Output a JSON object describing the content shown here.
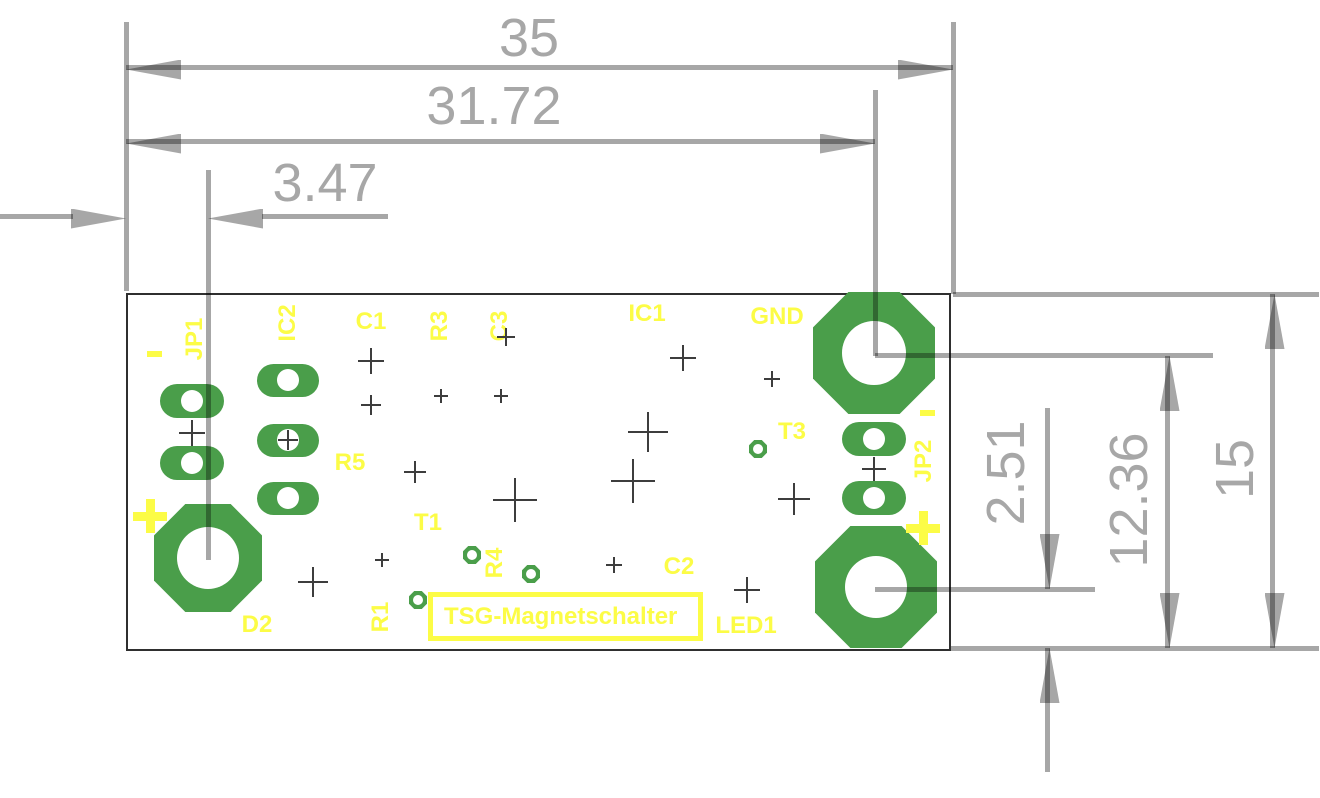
{
  "colors": {
    "pad_green": "#4a9e4a",
    "silk_yellow": "#fcfc46",
    "dim_gray": "#a7a7a7",
    "cross_dark": "#3d3d3d",
    "board_outline": "#2f2f2f"
  },
  "board": {
    "title": "TSG-Magnetschalter",
    "outline": {
      "x": 126,
      "y": 293,
      "w": 825,
      "h": 358
    },
    "title_box": {
      "x": 428,
      "y": 592,
      "w": 275,
      "h": 49
    }
  },
  "dimensions": {
    "texts": [
      {
        "name": "dim-text-35",
        "text": "35",
        "x": 529,
        "y": 38,
        "rot": 0
      },
      {
        "name": "dim-text-31-72",
        "text": "31.72",
        "x": 494,
        "y": 106,
        "rot": 0
      },
      {
        "name": "dim-text-3-47",
        "text": "3.47",
        "x": 325,
        "y": 183,
        "rot": 0
      },
      {
        "name": "dim-text-2-51",
        "text": "2.51",
        "x": 1006,
        "y": 473,
        "rot": -90
      },
      {
        "name": "dim-text-12-36",
        "text": "12.36",
        "x": 1129,
        "y": 500,
        "rot": -90
      },
      {
        "name": "dim-text-15",
        "text": "15",
        "x": 1235,
        "y": 469,
        "rot": -90
      }
    ],
    "lines": [
      {
        "name": "dim-line-35",
        "x": 126,
        "y": 65,
        "w": 827,
        "h": 5
      },
      {
        "name": "dim-line-31-72",
        "x": 126,
        "y": 139,
        "w": 749,
        "h": 5
      },
      {
        "name": "dim-tail-3-47-left",
        "x": 0,
        "y": 214,
        "w": 73,
        "h": 5
      },
      {
        "name": "dim-tail-3-47-right",
        "x": 262,
        "y": 214,
        "w": 126,
        "h": 5
      },
      {
        "name": "ext-line-left-edge",
        "x": 124,
        "y": 22,
        "w": 5,
        "h": 269
      },
      {
        "name": "ext-line-d2-center",
        "x": 206,
        "y": 170,
        "w": 5,
        "h": 390
      },
      {
        "name": "ext-line-gnd-center",
        "x": 873,
        "y": 90,
        "w": 5,
        "h": 266
      },
      {
        "name": "ext-line-right-edge",
        "x": 951,
        "y": 22,
        "w": 5,
        "h": 272
      },
      {
        "name": "ext-line-board-top",
        "x": 953,
        "y": 292,
        "w": 366,
        "h": 5
      },
      {
        "name": "ext-line-gnd-right",
        "x": 875,
        "y": 353,
        "w": 338,
        "h": 5
      },
      {
        "name": "ext-line-plus-right",
        "x": 875,
        "y": 587,
        "w": 220,
        "h": 5
      },
      {
        "name": "ext-line-board-bottom",
        "x": 951,
        "y": 646,
        "w": 368,
        "h": 5
      },
      {
        "name": "dim-line-15",
        "x": 1270,
        "y": 294,
        "w": 5,
        "h": 354
      },
      {
        "name": "dim-line-12-36",
        "x": 1165,
        "y": 356,
        "w": 5,
        "h": 292
      },
      {
        "name": "dim-line-2-51-upper",
        "x": 1045,
        "y": 408,
        "w": 5,
        "h": 181
      },
      {
        "name": "dim-line-2-51-lower",
        "x": 1045,
        "y": 648,
        "w": 5,
        "h": 124
      }
    ],
    "arrows": [
      {
        "dir": "left",
        "x": 126,
        "y": 67
      },
      {
        "dir": "right",
        "x": 953,
        "y": 67
      },
      {
        "dir": "left",
        "x": 126,
        "y": 141
      },
      {
        "dir": "right",
        "x": 875,
        "y": 141
      },
      {
        "dir": "right",
        "x": 126,
        "y": 216
      },
      {
        "dir": "left",
        "x": 208,
        "y": 216
      },
      {
        "dir": "up",
        "x": 1272,
        "y": 294
      },
      {
        "dir": "down",
        "x": 1272,
        "y": 648
      },
      {
        "dir": "up",
        "x": 1167,
        "y": 356
      },
      {
        "dir": "down",
        "x": 1167,
        "y": 648
      },
      {
        "dir": "down",
        "x": 1047,
        "y": 589
      },
      {
        "dir": "up",
        "x": 1047,
        "y": 648
      }
    ]
  },
  "pads": {
    "octagons": [
      {
        "name": "pad-d2",
        "cx": 208,
        "cy": 558,
        "size": 108,
        "hole_r": 31
      },
      {
        "name": "pad-gnd",
        "cx": 874,
        "cy": 353,
        "size": 122,
        "hole_r": 32
      },
      {
        "name": "pad-led-plus",
        "cx": 876,
        "cy": 587,
        "size": 122,
        "hole_r": 31
      }
    ],
    "ovals": [
      {
        "name": "pad-jp1-1",
        "cx": 192,
        "cy": 401,
        "w": 64,
        "h": 34,
        "hole_r": 11
      },
      {
        "name": "pad-jp1-2",
        "cx": 192,
        "cy": 463,
        "w": 64,
        "h": 34,
        "hole_r": 11
      },
      {
        "name": "pad-ic2-1",
        "cx": 288,
        "cy": 380,
        "w": 62,
        "h": 33,
        "hole_r": 11
      },
      {
        "name": "pad-ic2-2",
        "cx": 288,
        "cy": 440,
        "w": 62,
        "h": 33,
        "hole_r": 11
      },
      {
        "name": "pad-ic2-3",
        "cx": 288,
        "cy": 498,
        "w": 62,
        "h": 33,
        "hole_r": 11
      },
      {
        "name": "pad-jp2-1",
        "cx": 874,
        "cy": 439,
        "w": 64,
        "h": 34,
        "hole_r": 11
      },
      {
        "name": "pad-jp2-2",
        "cx": 874,
        "cy": 498,
        "w": 64,
        "h": 34,
        "hole_r": 11
      }
    ]
  },
  "vias": [
    {
      "name": "via-r4-a",
      "cx": 472,
      "cy": 555,
      "size": 18,
      "hole_r": 5
    },
    {
      "name": "via-r4-b",
      "cx": 531,
      "cy": 574,
      "size": 18,
      "hole_r": 5
    },
    {
      "name": "via-r1",
      "cx": 418,
      "cy": 600,
      "size": 18,
      "hole_r": 5
    },
    {
      "name": "via-t3",
      "cx": 758,
      "cy": 449,
      "size": 18,
      "hole_r": 5
    }
  ],
  "crosses": [
    {
      "cx": 371,
      "cy": 361,
      "arm": 13
    },
    {
      "cx": 371,
      "cy": 405,
      "arm": 10
    },
    {
      "cx": 441,
      "cy": 396,
      "arm": 7
    },
    {
      "cx": 501,
      "cy": 396,
      "arm": 7
    },
    {
      "cx": 506,
      "cy": 337,
      "arm": 9
    },
    {
      "cx": 415,
      "cy": 472,
      "arm": 11
    },
    {
      "cx": 515,
      "cy": 500,
      "arm": 22
    },
    {
      "cx": 382,
      "cy": 560,
      "arm": 7
    },
    {
      "cx": 313,
      "cy": 582,
      "arm": 15
    },
    {
      "cx": 683,
      "cy": 358,
      "arm": 13
    },
    {
      "cx": 772,
      "cy": 379,
      "arm": 8
    },
    {
      "cx": 648,
      "cy": 432,
      "arm": 20
    },
    {
      "cx": 633,
      "cy": 481,
      "arm": 22
    },
    {
      "cx": 794,
      "cy": 499,
      "arm": 16
    },
    {
      "cx": 614,
      "cy": 565,
      "arm": 8
    },
    {
      "cx": 747,
      "cy": 590,
      "arm": 13
    },
    {
      "cx": 874,
      "cy": 469,
      "arm": 12
    },
    {
      "cx": 192,
      "cy": 433,
      "arm": 13
    },
    {
      "cx": 288,
      "cy": 440,
      "arm": 10
    }
  ],
  "silkscreen": {
    "labels": [
      {
        "name": "label-jp1",
        "text": "JP1",
        "x": 195,
        "y": 339,
        "rot": -90
      },
      {
        "name": "label-ic2",
        "text": "IC2",
        "x": 288,
        "y": 323,
        "rot": -90
      },
      {
        "name": "label-c1",
        "text": "C1",
        "x": 371,
        "y": 322,
        "rot": 0
      },
      {
        "name": "label-r3",
        "text": "R3",
        "x": 440,
        "y": 326,
        "rot": -90
      },
      {
        "name": "label-c3",
        "text": "C3",
        "x": 500,
        "y": 326,
        "rot": -90
      },
      {
        "name": "label-ic1",
        "text": "IC1",
        "x": 647,
        "y": 314,
        "rot": 0
      },
      {
        "name": "label-gnd",
        "text": "GND",
        "x": 777,
        "y": 317,
        "rot": 0
      },
      {
        "name": "label-t3",
        "text": "T3",
        "x": 792,
        "y": 432,
        "rot": 0
      },
      {
        "name": "label-jp2",
        "text": "JP2",
        "x": 924,
        "y": 461,
        "rot": -90
      },
      {
        "name": "label-r5",
        "text": "R5",
        "x": 350,
        "y": 463,
        "rot": 0
      },
      {
        "name": "label-t1",
        "text": "T1",
        "x": 428,
        "y": 523,
        "rot": 0
      },
      {
        "name": "label-r4",
        "text": "R4",
        "x": 495,
        "y": 563,
        "rot": -90
      },
      {
        "name": "label-c2",
        "text": "C2",
        "x": 679,
        "y": 567,
        "rot": 0
      },
      {
        "name": "label-r1",
        "text": "R1",
        "x": 381,
        "y": 617,
        "rot": -90
      },
      {
        "name": "label-d2",
        "text": "D2",
        "x": 257,
        "y": 625,
        "rot": 0
      },
      {
        "name": "label-led1",
        "text": "LED1",
        "x": 746,
        "y": 626,
        "rot": 0
      }
    ],
    "plus_marks": [
      {
        "name": "plus-mark-d2",
        "x": 150,
        "y": 516,
        "size": 34,
        "bar": 9
      },
      {
        "name": "plus-mark-jp2",
        "x": 923,
        "y": 528,
        "size": 34,
        "bar": 9
      }
    ],
    "minus_marks": [
      {
        "name": "minus-mark-jp1",
        "x": 154,
        "y": 354,
        "w": 15,
        "h": 6
      },
      {
        "name": "minus-mark-jp2",
        "x": 927,
        "y": 413,
        "w": 15,
        "h": 6
      }
    ]
  }
}
